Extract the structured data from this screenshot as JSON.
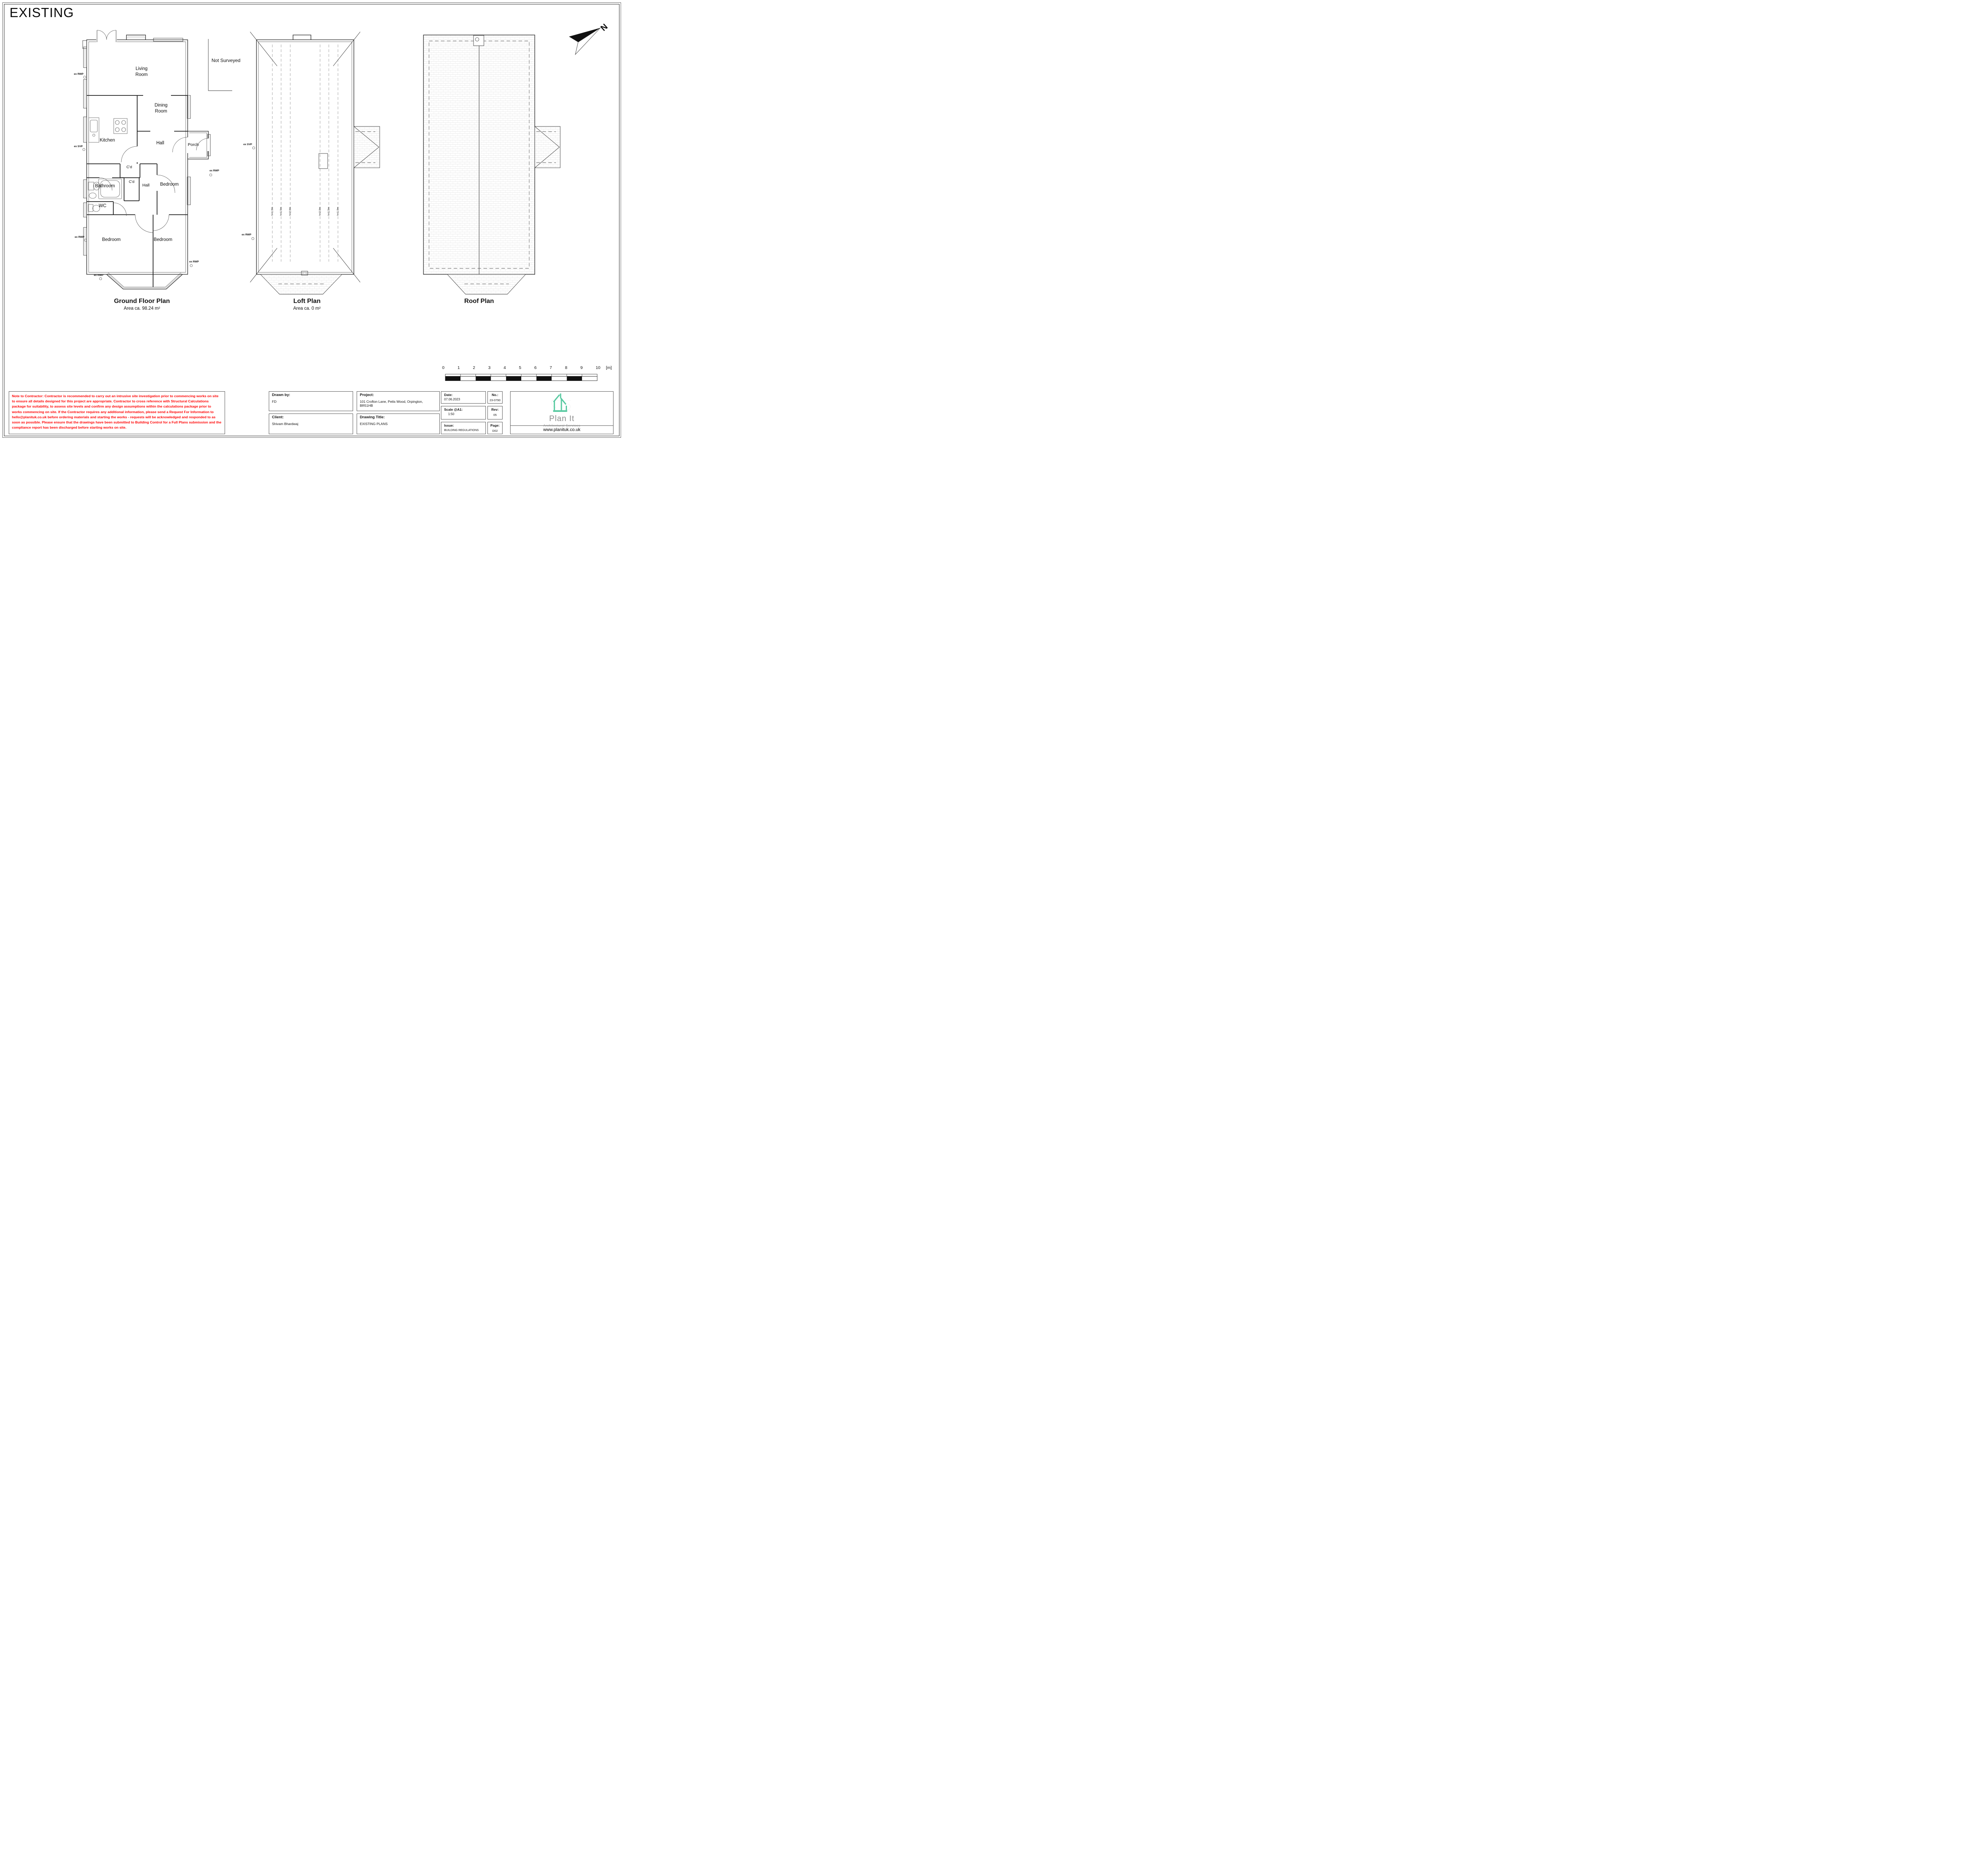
{
  "sheet": {
    "title": "EXISTING"
  },
  "plans": {
    "ground_floor": {
      "caption": "Ground Floor Plan",
      "area": "Area ca. 98.24 m²",
      "rooms": {
        "living": "Living\nRoom",
        "dining": "Dining\nRoom",
        "kitchen": "Kitchen",
        "hall": "Hall",
        "porch": "Porch",
        "closet1": "C'd",
        "closet2": "C'd",
        "inner_hall": "Hall",
        "bathroom": "Bathroom",
        "wc": "WC",
        "bedroom_right": "Bedroom",
        "bedroom_bottom_left": "Bedroom",
        "bedroom_bottom_right": "Bedroom"
      },
      "not_surveyed": "Not Surveyed"
    },
    "loft": {
      "caption": "Loft Plan",
      "area": "Area ca. 0 m²",
      "height_lines": [
        "h=1.0m",
        "h=1.5m",
        "h=2.0m",
        "h=2.0m",
        "h=1.5m",
        "h=1.0m"
      ]
    },
    "roof": {
      "caption": "Roof Plan"
    }
  },
  "annotations": {
    "rwp": "ex RWP",
    "svp": "ex SVP"
  },
  "north_arrow": {
    "label": "N"
  },
  "scale_bar": {
    "ticks": [
      "0",
      "1",
      "2",
      "3",
      "4",
      "5",
      "6",
      "7",
      "8",
      "9",
      "10"
    ],
    "unit": "[m]"
  },
  "note": {
    "color": "#ff0000",
    "text": "Note to Contractor: Contractor is recommended to carry out an intrusive site investigation prior to commencing works on site to ensure all details designed for this project are appropriate. Contractor to cross reference with Structural Calculations package for suitability, to assess site levels and confirm any design assumptions within the calculations package prior to works commencing on site. If the Contractor requires any additional information, please send a Request For Information to hello@planituk.co.uk before ordering materials and starting the works - requests will be acknowledged and responded to as soon as possible. Please ensure that the drawings have been submitted to Building Control for a Full Plans submission and the compliance report has been discharged before starting works on site."
  },
  "title_block": {
    "drawn_by": {
      "label": "Drawn by:",
      "value": "FD"
    },
    "client": {
      "label": "Client:",
      "value": "Shivam Bhardwaj"
    },
    "project": {
      "label": "Project:",
      "value": "101 Crofton Lane, Petts Wood, Orpington, BR51HB"
    },
    "drawing_title": {
      "label": "Drawing Title:",
      "value": "EXISTING PLANS"
    },
    "date": {
      "label": "Date:",
      "value": "07.06.2023"
    },
    "scale": {
      "label": "Scale @A1:",
      "value": "1:50"
    },
    "issue": {
      "label": "Issue:",
      "value": "BUILDING REGULATIONS"
    },
    "number": {
      "label": "No.:",
      "value": "23-0790"
    },
    "rev": {
      "label": "Rev:",
      "value": "05"
    },
    "page": {
      "label": "Page:",
      "value": "D02"
    }
  },
  "logo": {
    "name": "Plan It",
    "tagline": "Architectural Services",
    "url": "www.planituk.co.uk",
    "accent_color": "#57c9a0"
  }
}
